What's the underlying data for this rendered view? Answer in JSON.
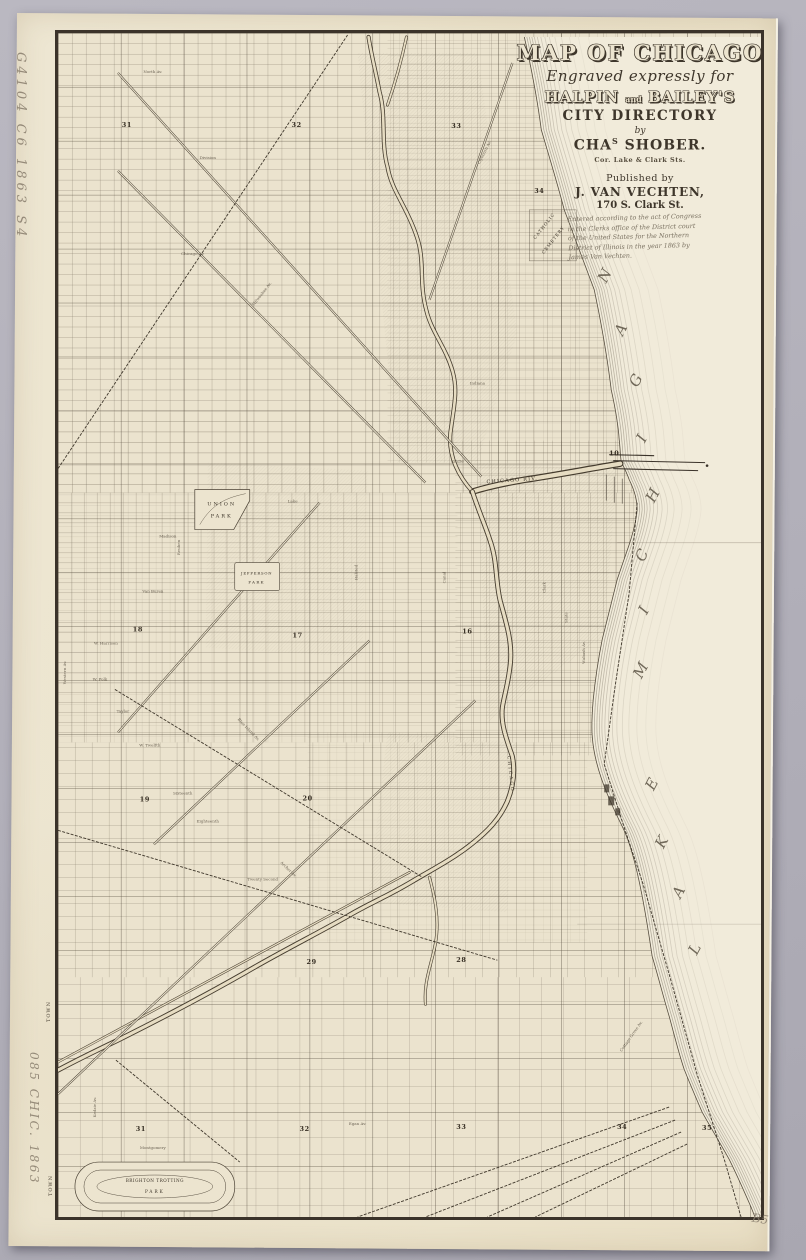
{
  "page": {
    "backdrop_color": "#b3b1ba",
    "paper_color": "#ece4cf",
    "ink_color": "#3b332a",
    "lake_color": "#f1ebda"
  },
  "title_block": {
    "title": "MAP OF CHICAGO",
    "subtitle": "Engraved expressly for",
    "halpin": "HALPIN",
    "and": "and",
    "baileys": "BAILEY'S",
    "directory": "CITY DIRECTORY",
    "by": "by",
    "engraver_pre": "CHA",
    "engraver_sup": "S",
    "engraver_post": " SHOBER.",
    "engraver_addr": "Cor. Lake & Clark Sts.",
    "published_by": "Published by",
    "publisher": "J. VAN VECHTEN,",
    "publisher_addr": "170 S. Clark St.",
    "copyright": "Entered according to the act of Congress\nin the Clerks office of the District court\nof the United States for the Northern\nDistrict of Illinois in the year 1863 by\nJames Van Vechten."
  },
  "annotations": {
    "call_number": "G4104 C6 1863 S4",
    "accession": "085 CHIC. 1863",
    "corner_note": "B5",
    "town_label_1": "TOWN",
    "town_label_2": "TOWN"
  },
  "map": {
    "lake_letters": [
      {
        "ch": "M",
        "x": 588,
        "y": 640
      },
      {
        "ch": "I",
        "x": 591,
        "y": 580
      },
      {
        "ch": "C",
        "x": 589,
        "y": 525
      },
      {
        "ch": "H",
        "x": 600,
        "y": 465
      },
      {
        "ch": "I",
        "x": 589,
        "y": 408
      },
      {
        "ch": "G",
        "x": 583,
        "y": 350
      },
      {
        "ch": "A",
        "x": 568,
        "y": 299
      },
      {
        "ch": "N",
        "x": 552,
        "y": 245
      },
      {
        "ch": "L",
        "x": 642,
        "y": 919
      },
      {
        "ch": "A",
        "x": 626,
        "y": 862
      },
      {
        "ch": "K",
        "x": 609,
        "y": 812
      },
      {
        "ch": "E",
        "x": 599,
        "y": 754
      }
    ],
    "section_numbers": [
      {
        "n": "31",
        "x": 69,
        "y": 94
      },
      {
        "n": "32",
        "x": 239,
        "y": 94
      },
      {
        "n": "33",
        "x": 399,
        "y": 95
      },
      {
        "n": "34",
        "x": 482,
        "y": 160
      },
      {
        "n": "10",
        "x": 557,
        "y": 423
      },
      {
        "n": "18",
        "x": 80,
        "y": 599
      },
      {
        "n": "17",
        "x": 240,
        "y": 605
      },
      {
        "n": "16",
        "x": 410,
        "y": 601
      },
      {
        "n": "19",
        "x": 87,
        "y": 769
      },
      {
        "n": "20",
        "x": 250,
        "y": 768
      },
      {
        "n": "29",
        "x": 254,
        "y": 932
      },
      {
        "n": "28",
        "x": 404,
        "y": 930
      },
      {
        "n": "31",
        "x": 83,
        "y": 1099
      },
      {
        "n": "32",
        "x": 247,
        "y": 1099
      },
      {
        "n": "33",
        "x": 404,
        "y": 1097
      },
      {
        "n": "34",
        "x": 565,
        "y": 1097
      },
      {
        "n": "35",
        "x": 650,
        "y": 1098
      }
    ],
    "place_labels": [
      {
        "text": "UNION",
        "x": 164,
        "y": 473,
        "s": 5,
        "ls": 2
      },
      {
        "text": "PARK",
        "x": 164,
        "y": 485,
        "s": 5,
        "ls": 2
      },
      {
        "text": "JEFFERSON",
        "x": 199,
        "y": 542,
        "s": 3.8,
        "ls": 0.8
      },
      {
        "text": "PARK",
        "x": 199,
        "y": 551,
        "s": 3.8,
        "ls": 1.5
      },
      {
        "text": "CATHOLIC",
        "x": 488,
        "y": 194,
        "s": 4.3,
        "ls": 1,
        "rot": -52
      },
      {
        "text": "CEMETERY",
        "x": 497,
        "y": 208,
        "s": 4.3,
        "ls": 1,
        "rot": -52
      },
      {
        "text": "CHICAGO RIV.",
        "x": 455,
        "y": 449,
        "s": 5,
        "ls": 1.2,
        "rot": -4
      },
      {
        "text": "CHICAGO",
        "x": 452,
        "y": 742,
        "s": 4.5,
        "ls": 2,
        "rot": 84
      },
      {
        "text": "BRIGHTON TROTTING",
        "x": 97,
        "y": 1150,
        "s": 4.2,
        "ls": 0.5
      },
      {
        "text": "PARK",
        "x": 97,
        "y": 1161,
        "s": 4.2,
        "ls": 2
      }
    ],
    "street_labels": [
      {
        "text": "North Av.",
        "x": 95,
        "y": 40
      },
      {
        "text": "Division",
        "x": 150,
        "y": 126
      },
      {
        "text": "Chicago Av.",
        "x": 135,
        "y": 222
      },
      {
        "text": "Indiana",
        "x": 420,
        "y": 352
      },
      {
        "text": "Kinzie",
        "x": 400,
        "y": 430
      },
      {
        "text": "Lake",
        "x": 235,
        "y": 470
      },
      {
        "text": "Madison",
        "x": 110,
        "y": 505
      },
      {
        "text": "Van Buren",
        "x": 95,
        "y": 560
      },
      {
        "text": "W. Harrison",
        "x": 48,
        "y": 612
      },
      {
        "text": "W. Polk",
        "x": 42,
        "y": 648
      },
      {
        "text": "Taylor",
        "x": 65,
        "y": 680
      },
      {
        "text": "W. Twelfth",
        "x": 92,
        "y": 714
      },
      {
        "text": "Sixteenth",
        "x": 125,
        "y": 762
      },
      {
        "text": "Eighteenth",
        "x": 150,
        "y": 790
      },
      {
        "text": "Twenty Second",
        "x": 205,
        "y": 848
      },
      {
        "text": "Egan Av.",
        "x": 300,
        "y": 1093
      },
      {
        "text": "Montgomery",
        "x": 95,
        "y": 1117
      },
      {
        "text": "Western Av.",
        "x": 8,
        "y": 640,
        "rot": -90
      },
      {
        "text": "Reuben",
        "x": 122,
        "y": 515,
        "rot": -90
      },
      {
        "text": "Halsted",
        "x": 300,
        "y": 540,
        "rot": -90
      },
      {
        "text": "Canal",
        "x": 388,
        "y": 545,
        "rot": -90
      },
      {
        "text": "Clark",
        "x": 488,
        "y": 555,
        "rot": -90
      },
      {
        "text": "State",
        "x": 510,
        "y": 585,
        "rot": -90
      },
      {
        "text": "Wabash Av.",
        "x": 528,
        "y": 620,
        "rot": -90
      },
      {
        "text": "Kedzie Av.",
        "x": 38,
        "y": 1075,
        "rot": -90
      },
      {
        "text": "Cottage Grove Av.",
        "x": 575,
        "y": 1005,
        "rot": -55
      },
      {
        "text": "Milwaukee Av.",
        "x": 205,
        "y": 262,
        "rot": -52
      },
      {
        "text": "Clybourn Av.",
        "x": 428,
        "y": 120,
        "rot": -63
      },
      {
        "text": "Blue Island Av.",
        "x": 190,
        "y": 698,
        "rot": 46
      },
      {
        "text": "Archer Av.",
        "x": 230,
        "y": 838,
        "rot": 44
      }
    ]
  }
}
